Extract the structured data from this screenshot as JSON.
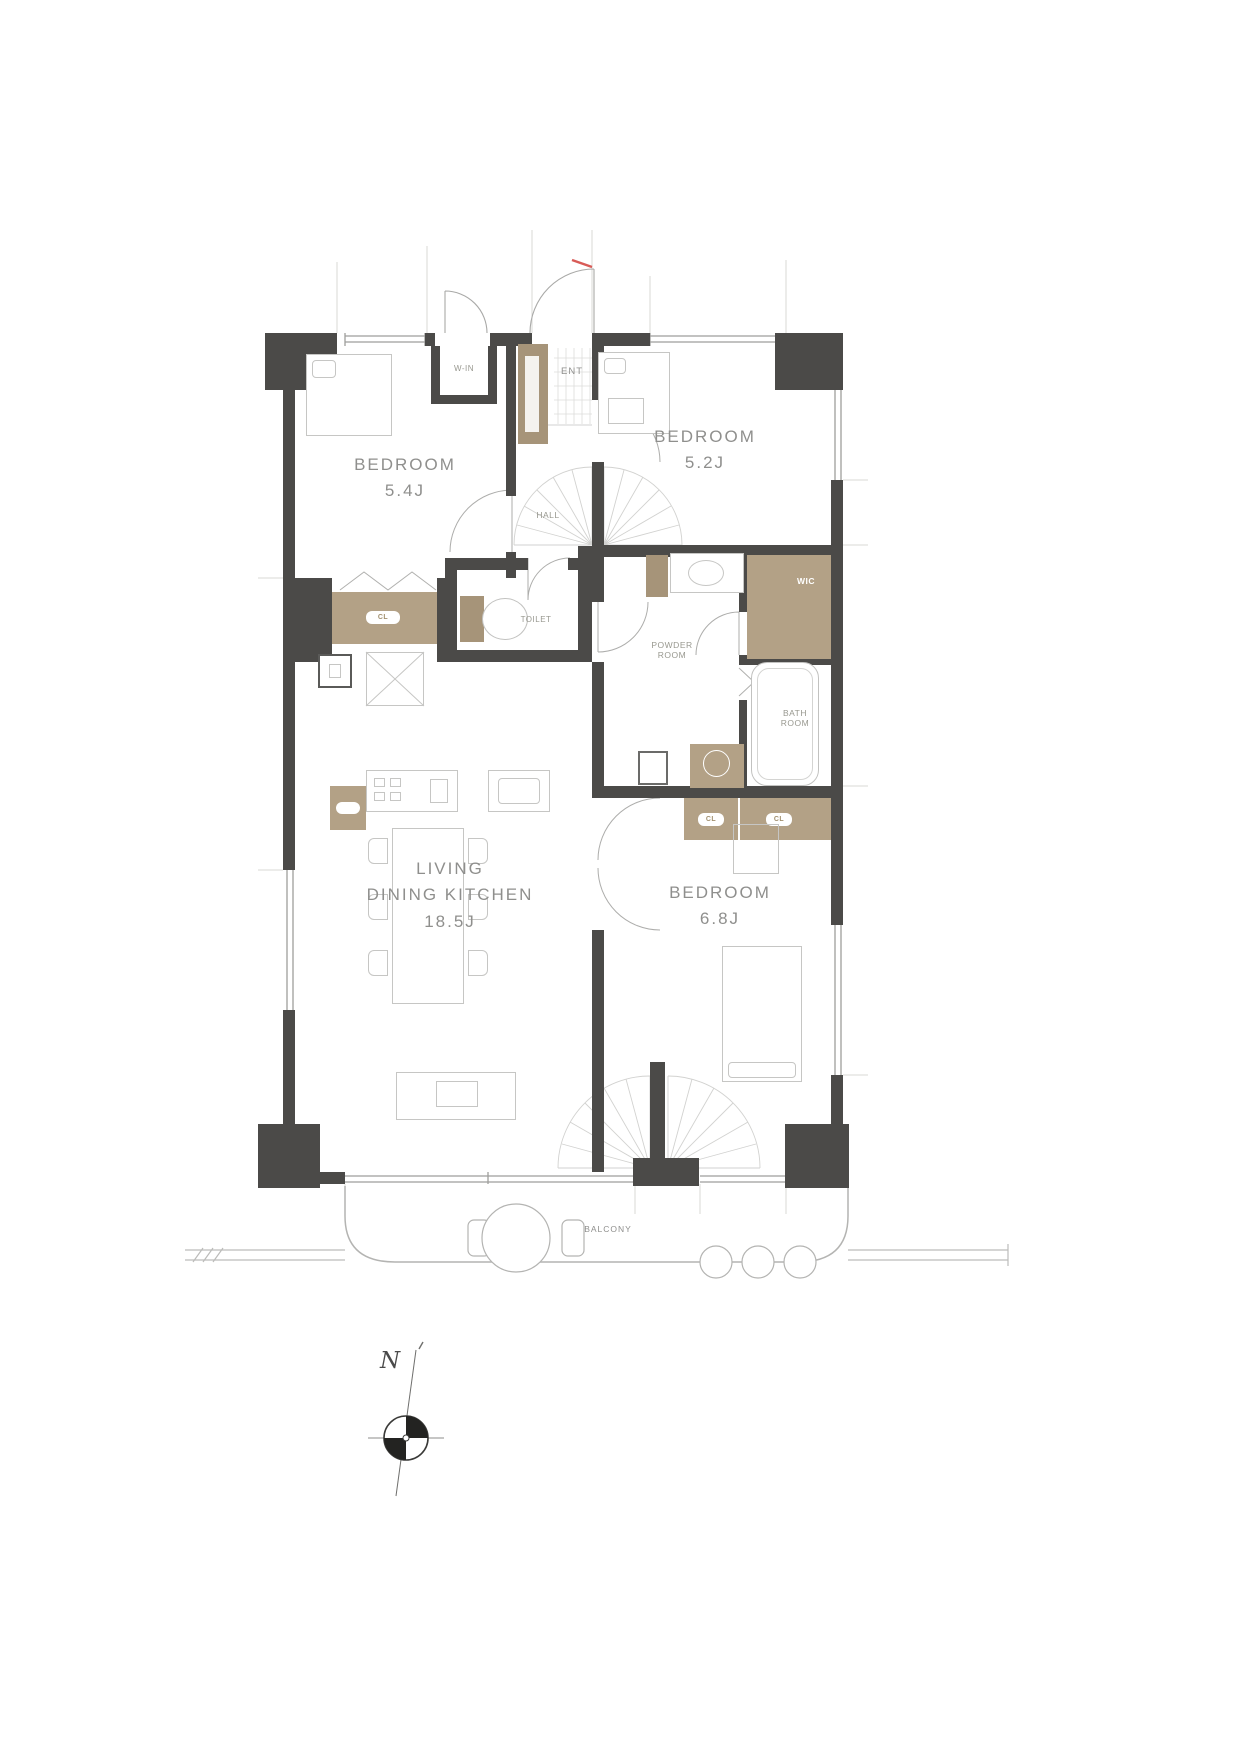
{
  "rooms": {
    "bedroom_a": {
      "label": "BEDROOM",
      "size": "5.4J"
    },
    "bedroom_b": {
      "label": "BEDROOM",
      "size": "5.2J"
    },
    "bedroom_c": {
      "label": "BEDROOM",
      "size": "6.8J"
    },
    "ldk": {
      "label_line1": "LIVING",
      "label_line2": "DINING KITCHEN",
      "size": "18.5J"
    },
    "entrance": {
      "label": "ENT"
    },
    "hall": {
      "label": "HALL"
    },
    "toilet": {
      "label": "TOILET"
    },
    "powder_room": {
      "label_line1": "POWDER",
      "label_line2": "ROOM"
    },
    "bath_room": {
      "label_line1": "BATH",
      "label_line2": "ROOM"
    },
    "wic": {
      "label": "WIC"
    },
    "walk_in_storage": {
      "label": "W-IN"
    },
    "balcony": {
      "label": "BALCONY"
    }
  },
  "fixtures": {
    "closet_label": "CL"
  },
  "compass": {
    "north_label": "N"
  },
  "colors": {
    "wall": "#4b4a48",
    "cabinet": "#b3a186",
    "cabinet_dark": "#a69479",
    "outline": "#c6c6c4",
    "text": "#8f8f8d",
    "accent_red": "#d85b57"
  }
}
